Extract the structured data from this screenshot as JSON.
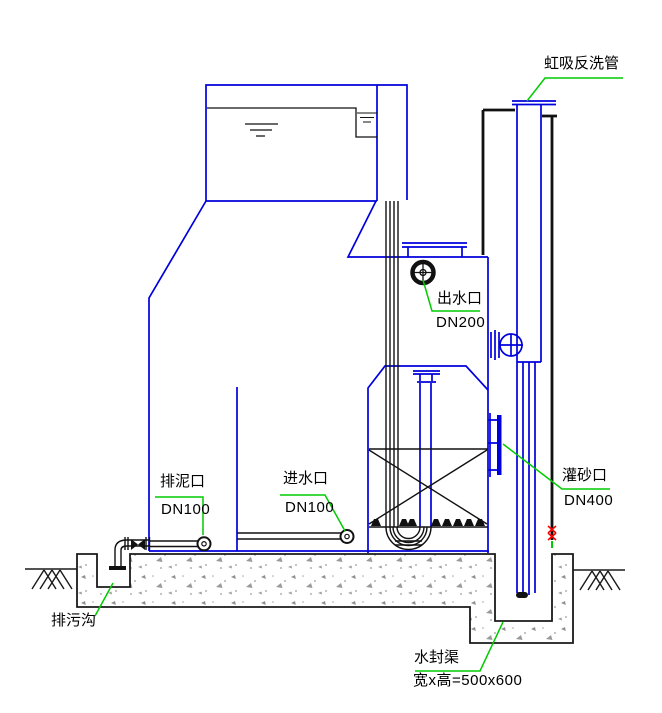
{
  "drawing": {
    "type": "engineering-section-diagram",
    "subject": "valveless gravity filter tank section",
    "labels": {
      "siphon": {
        "text": "虹吸反洗管"
      },
      "outlet": {
        "title": "出水口",
        "spec": "DN200"
      },
      "mud": {
        "title": "排泥口",
        "spec": "DN100"
      },
      "inlet": {
        "title": "进水口",
        "spec": "DN100"
      },
      "sand": {
        "title": "灌砂口",
        "spec": "DN400"
      },
      "sewage_ditch": {
        "text": "排污沟"
      },
      "water_seal": {
        "title": "水封渠",
        "spec": "宽x高=500x600"
      }
    },
    "colors": {
      "structure_blue": "#0000dd",
      "line_black": "#111111",
      "leader_green": "#00cc00",
      "mark_red": "#ff0000",
      "concrete_gray": "#9a9a9a"
    }
  }
}
